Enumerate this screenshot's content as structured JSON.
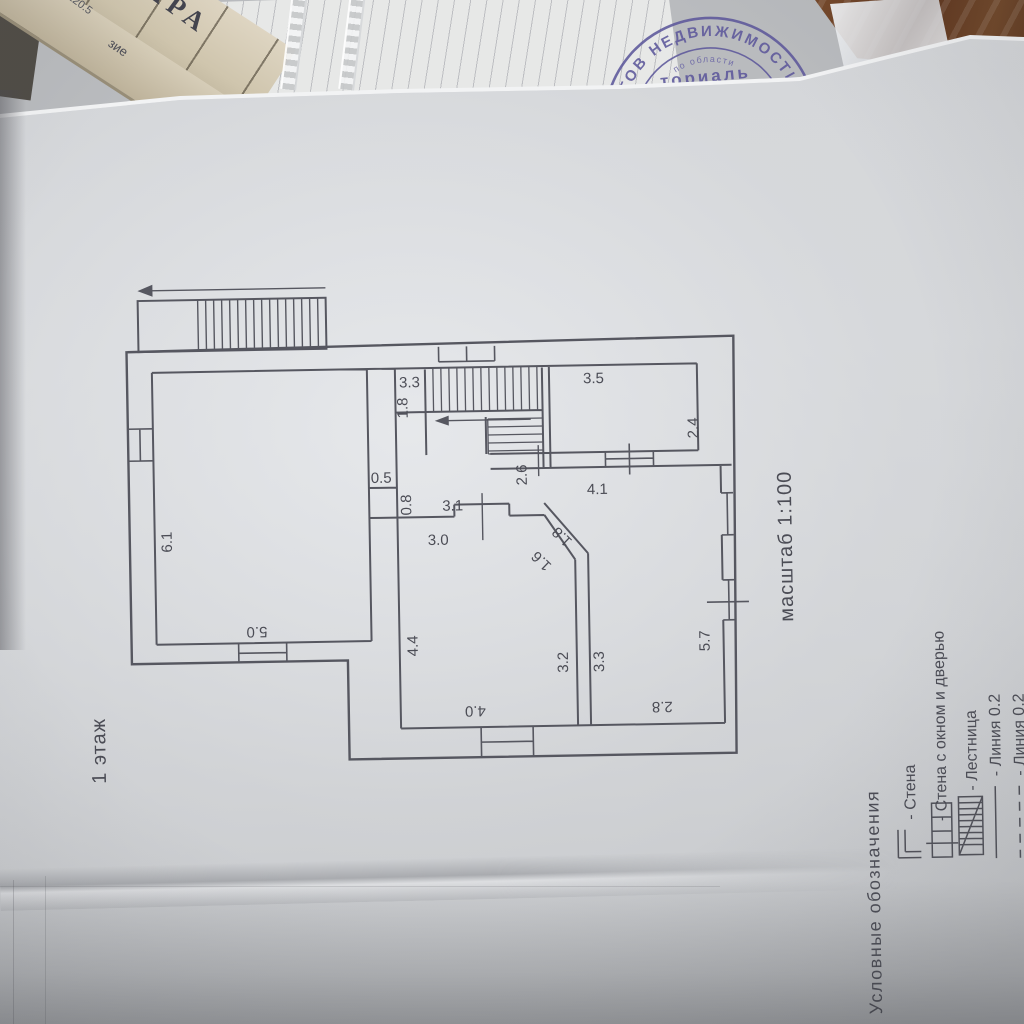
{
  "document": {
    "floor_title": "1 этаж",
    "scale_label": "масштаб 1:100"
  },
  "plan": {
    "dims": [
      {
        "id": "living-room-side",
        "value": "6.1"
      },
      {
        "id": "living-room-bottom",
        "value": "5.0"
      },
      {
        "id": "stair-nook-width",
        "value": "3.3"
      },
      {
        "id": "stair-nook-depth",
        "value": "1.8"
      },
      {
        "id": "top-right-room-width",
        "value": "3.5"
      },
      {
        "id": "top-right-room-height",
        "value": "2.4"
      },
      {
        "id": "stair-exit-width",
        "value": "2.6"
      },
      {
        "id": "top-right-room-bottom",
        "value": "4.1"
      },
      {
        "id": "closet-width",
        "value": "0.5"
      },
      {
        "id": "closet-depth",
        "value": "0.8"
      },
      {
        "id": "hall-wall-top",
        "value": "3.1"
      },
      {
        "id": "hall-wall-bottom",
        "value": "3.0"
      },
      {
        "id": "diagonal-outer",
        "value": "1.8"
      },
      {
        "id": "diagonal-inner",
        "value": "1.6"
      },
      {
        "id": "bottom-left-room-side",
        "value": "4.4"
      },
      {
        "id": "bottom-left-room-right",
        "value": "3.2"
      },
      {
        "id": "bottom-right-room-left",
        "value": "3.3"
      },
      {
        "id": "bottom-right-room-side",
        "value": "5.7"
      },
      {
        "id": "bottom-left-room-bottom",
        "value": "4.0"
      },
      {
        "id": "bottom-right-room-bottom",
        "value": "2.8"
      }
    ]
  },
  "legend": {
    "header": "Условные обозначения",
    "items": [
      {
        "icon": "wall-corner-icon",
        "label": "- Стена"
      },
      {
        "icon": "wall-window-door-icon",
        "label": "- Стена с окном и дверью"
      },
      {
        "icon": "stairs-icon",
        "label": "- Лестница"
      },
      {
        "icon": "solid-line-icon",
        "label": "- Линия 0.2"
      },
      {
        "icon": "dashed-line-icon",
        "label": "- Линия 0.2"
      }
    ]
  },
  "background": {
    "stamp": {
      "arc_text": "КТОВ НЕДВИЖИМОСТИ",
      "inner_arc_text": "по области",
      "center_text": "ториаль"
    },
    "papers": {
      "big_letters": "ПАРА",
      "fragment_top": "120.5",
      "fragment_side": "зие"
    }
  },
  "colors": {
    "paper": "#d3d5d8",
    "ink_line": "#565760",
    "ink_text": "#4b4c55",
    "stamp": "#5d589b",
    "wood": "#6b4427",
    "old_paper": "#cfc5ad"
  }
}
